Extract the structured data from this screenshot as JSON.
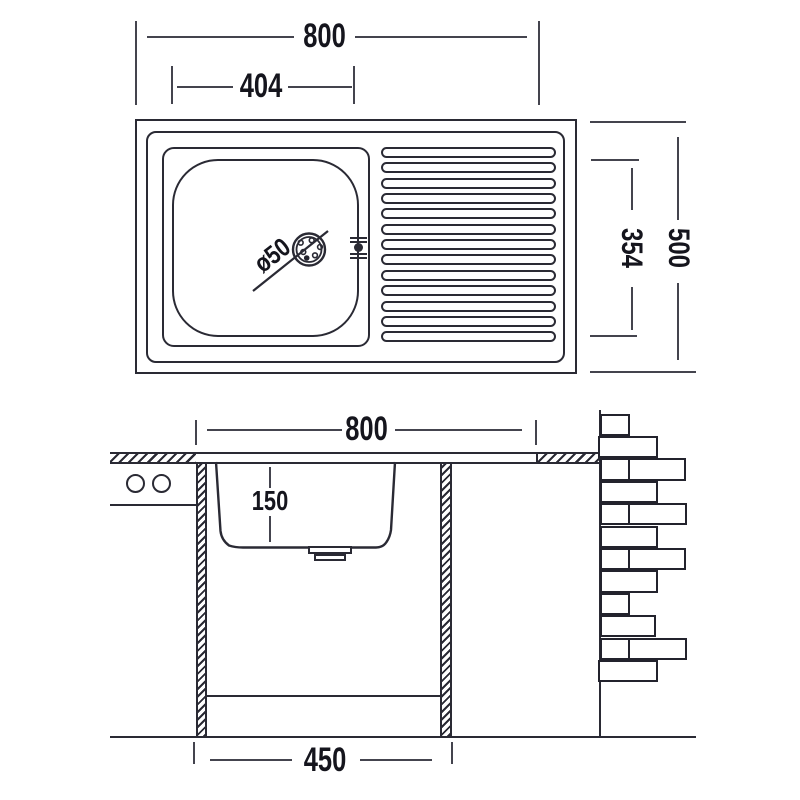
{
  "drawing": {
    "type": "sink-dimension-diagram",
    "background": "#ffffff",
    "line_color": "#2a2a34",
    "text_color": "#15151d"
  },
  "top_view": {
    "dim_overall_width": "800",
    "dim_bowl_width": "404",
    "dim_overall_depth": "500",
    "dim_bowl_depth": "354",
    "drain_diameter_label": "ø50",
    "ridge_count": 13,
    "ridge_geometry": {
      "first_top": 147,
      "step": 15.35
    }
  },
  "section_view": {
    "dim_overall_width": "800",
    "dim_bowl_height": "150",
    "dim_cabinet_width": "450",
    "brick_geometry": {
      "first_top": 413.5,
      "row_height": 22.4,
      "rows": [
        [
          [
            600,
            30
          ]
        ],
        [
          [
            598,
            60
          ]
        ],
        [
          [
            600,
            30
          ],
          [
            628,
            58
          ]
        ],
        [
          [
            600,
            58
          ]
        ],
        [
          [
            600,
            30
          ],
          [
            628,
            59
          ]
        ],
        [
          [
            600,
            58
          ]
        ],
        [
          [
            600,
            30
          ],
          [
            628,
            58
          ]
        ],
        [
          [
            600,
            58
          ]
        ],
        [
          [
            600,
            30
          ]
        ],
        [
          [
            600,
            56
          ]
        ],
        [
          [
            600,
            30
          ],
          [
            628,
            59
          ]
        ],
        [
          [
            598,
            60
          ]
        ]
      ]
    }
  }
}
